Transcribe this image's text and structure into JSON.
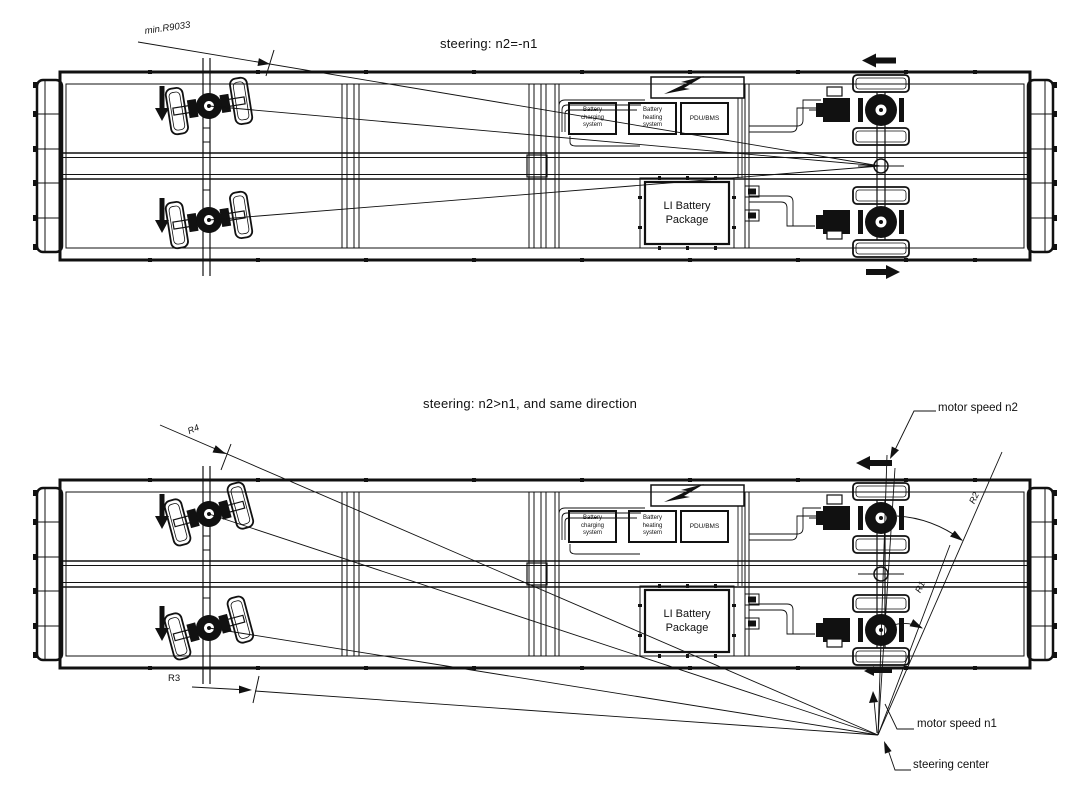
{
  "colors": {
    "line": "#111111",
    "background": "#ffffff"
  },
  "diagram_top": {
    "title": "steering: n2=-n1",
    "min_radius_label": "min.R9033"
  },
  "diagram_bottom": {
    "title": "steering: n2>n1, and  same direction",
    "labels": {
      "r1": "R1",
      "r2": "R2",
      "r3": "R3",
      "r4": "R4",
      "motor_speed_n2": "motor speed n2",
      "motor_speed_n1": "motor speed n1",
      "steering_center": "steering center"
    }
  },
  "vehicle_components": {
    "battery_charging": "Battery\ncharging\nsystem",
    "battery_heating": "Battery\nheating\nsystem",
    "pdu_bms": "PDU/BMS",
    "li_battery": "LI Battery\nPackage"
  }
}
